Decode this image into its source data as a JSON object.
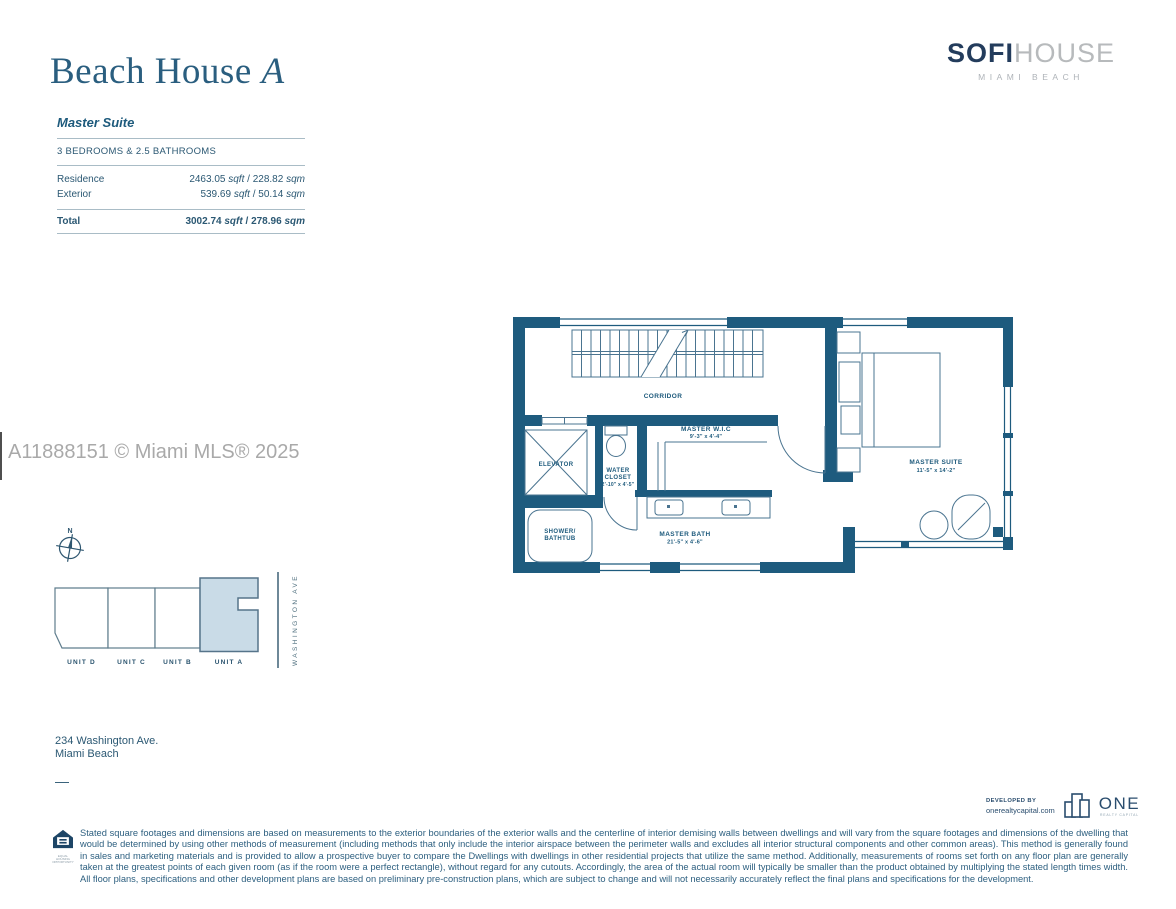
{
  "brand": {
    "sofi": "SOFI",
    "house": "HOUSE",
    "tagline": "MIAMI BEACH"
  },
  "plan": {
    "title_main": "Beach House",
    "title_variant": "A",
    "suite_name": "Master Suite",
    "config": "3 BEDROOMS & 2.5 BATHROOMS",
    "table": {
      "unit_sqft": "sqft",
      "unit_sqm": "sqm",
      "separator": " / ",
      "rows": [
        {
          "label": "Residence",
          "sqft": "2463.05",
          "sqm": "228.82"
        },
        {
          "label": "Exterior",
          "sqft": "539.69",
          "sqm": "50.14"
        }
      ],
      "total": {
        "label": "Total",
        "sqft": "3002.74",
        "sqm": "278.96"
      }
    }
  },
  "watermark": {
    "text": "A11888151 © Miami MLS® 2025"
  },
  "floor_plan": {
    "rooms": {
      "corridor": {
        "name": "CORRIDOR"
      },
      "elevator": {
        "name": "ELEVATOR"
      },
      "water_closet": {
        "name_line1": "WATER",
        "name_line2": "CLOSET",
        "dims": "2'-10\" x 4'-5\""
      },
      "shower": {
        "name_line1": "SHOWER/",
        "name_line2": "BATHTUB"
      },
      "master_wic": {
        "name": "MASTER W.I.C",
        "dims": "9'-3\" x 4'-4\""
      },
      "master_bath": {
        "name": "MASTER BATH",
        "dims": "21'-5\" x 4'-6\""
      },
      "master_suite": {
        "name": "MASTER SUITE",
        "dims": "11'-5\" x 14'-2\""
      }
    }
  },
  "site_plan": {
    "compass": "N",
    "street": "WASHINGTON AVE",
    "units": [
      {
        "label": "UNIT D"
      },
      {
        "label": "UNIT C"
      },
      {
        "label": "UNIT B"
      },
      {
        "label": "UNIT A"
      }
    ]
  },
  "address": {
    "line1": "234 Washington Ave.",
    "line2": "Miami Beach",
    "dash": "—"
  },
  "footer": {
    "equal_housing": "EQUAL HOUSING OPPORTUNITY",
    "disclaimer": "Stated square footages and dimensions are based on measurements to the exterior boundaries of the exterior walls and the centerline of interior demising walls between dwellings and will vary from the square footages and dimensions of the dwelling that would be determined by using other methods of measurement (including methods that only include the interior airspace between the perimeter walls and excludes all interior structural components and other common areas). This method is generally found in sales and marketing materials and is provided to allow a prospective buyer to compare the Dwellings with dwellings in other residential projects that utilize the same method.  Additionally, measurements of rooms set forth on any floor plan are generally taken at the greatest points of each given room (as if the room were a perfect rectangle), without regard for any cutouts. Accordingly, the area of the actual room will typically be smaller than the product obtained by multiplying the stated length times width. All floor plans, specifications and other development plans are based on preliminary pre-construction plans, which are subject to change and will not necessarily accurately reflect the final plans and specifications for the development.",
    "developed_by_label": "DEVELOPED BY",
    "developer_url": "onerealtycapital.com",
    "developer_name": "ONE",
    "developer_tagline": "REALTY CAPITAL"
  },
  "colors": {
    "wall": "#1e5b7e",
    "accent_text": "#1d5a7c",
    "unit_a_fill": "#c9dbe7",
    "brand_navy": "#233c5c",
    "brand_gray": "#b7babc",
    "watermark_gray": "#9e9e9e"
  }
}
